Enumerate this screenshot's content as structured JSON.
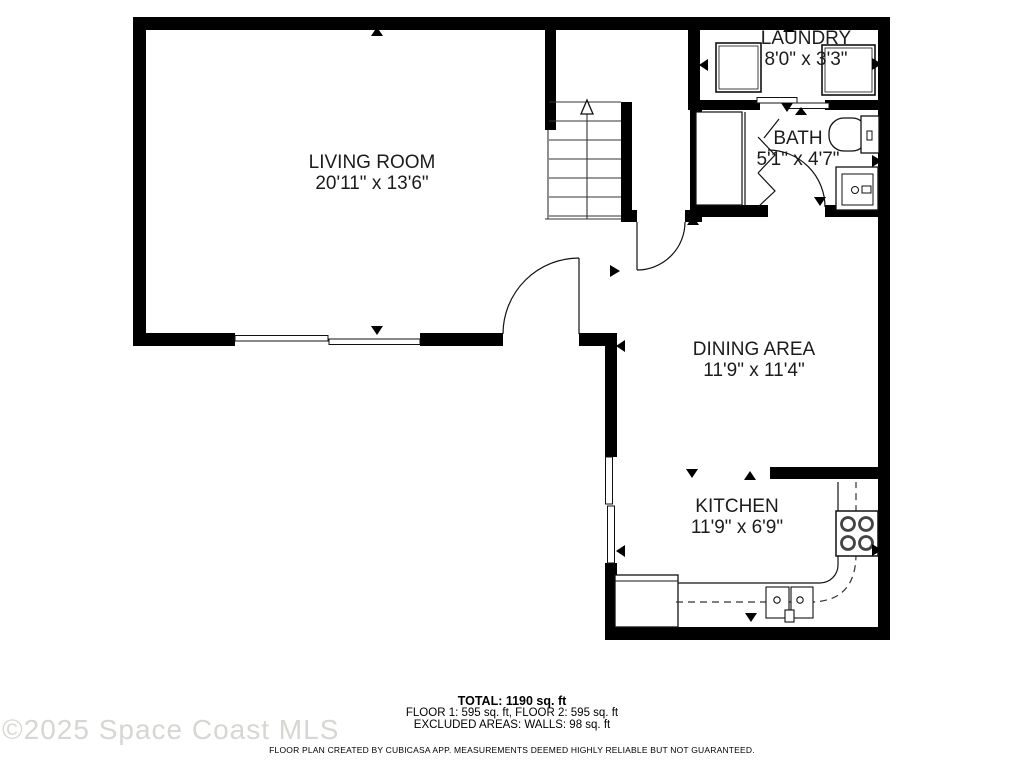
{
  "floor_plan": {
    "rooms": [
      {
        "id": "living-room",
        "name": "LIVING ROOM",
        "dimensions": "20'11\" x 13'6\""
      },
      {
        "id": "laundry",
        "name": "LAUNDRY",
        "dimensions": "8'0\" x 3'3\""
      },
      {
        "id": "bath",
        "name": "BATH",
        "dimensions": "5'1\" x 4'7\""
      },
      {
        "id": "dining-area",
        "name": "DINING AREA",
        "dimensions": "11'9\" x 11'4\""
      },
      {
        "id": "kitchen",
        "name": "KITCHEN",
        "dimensions": "11'9\" x 6'9\""
      }
    ],
    "summary": {
      "total": "TOTAL: 1190 sq. ft",
      "floors": "FLOOR 1: 595 sq. ft, FLOOR 2: 595 sq. ft",
      "excluded": "EXCLUDED AREAS: WALLS: 98 sq. ft",
      "disclaimer": "FLOOR PLAN CREATED BY CUBICASA APP. MEASUREMENTS DEEMED HIGHLY RELIABLE BUT NOT GUARANTEED."
    },
    "watermark": "©2025 Space Coast MLS",
    "colors": {
      "wall": "#000000",
      "text": "#1c1c1c",
      "watermark": "#d6d6d2",
      "line": "#111111"
    }
  }
}
